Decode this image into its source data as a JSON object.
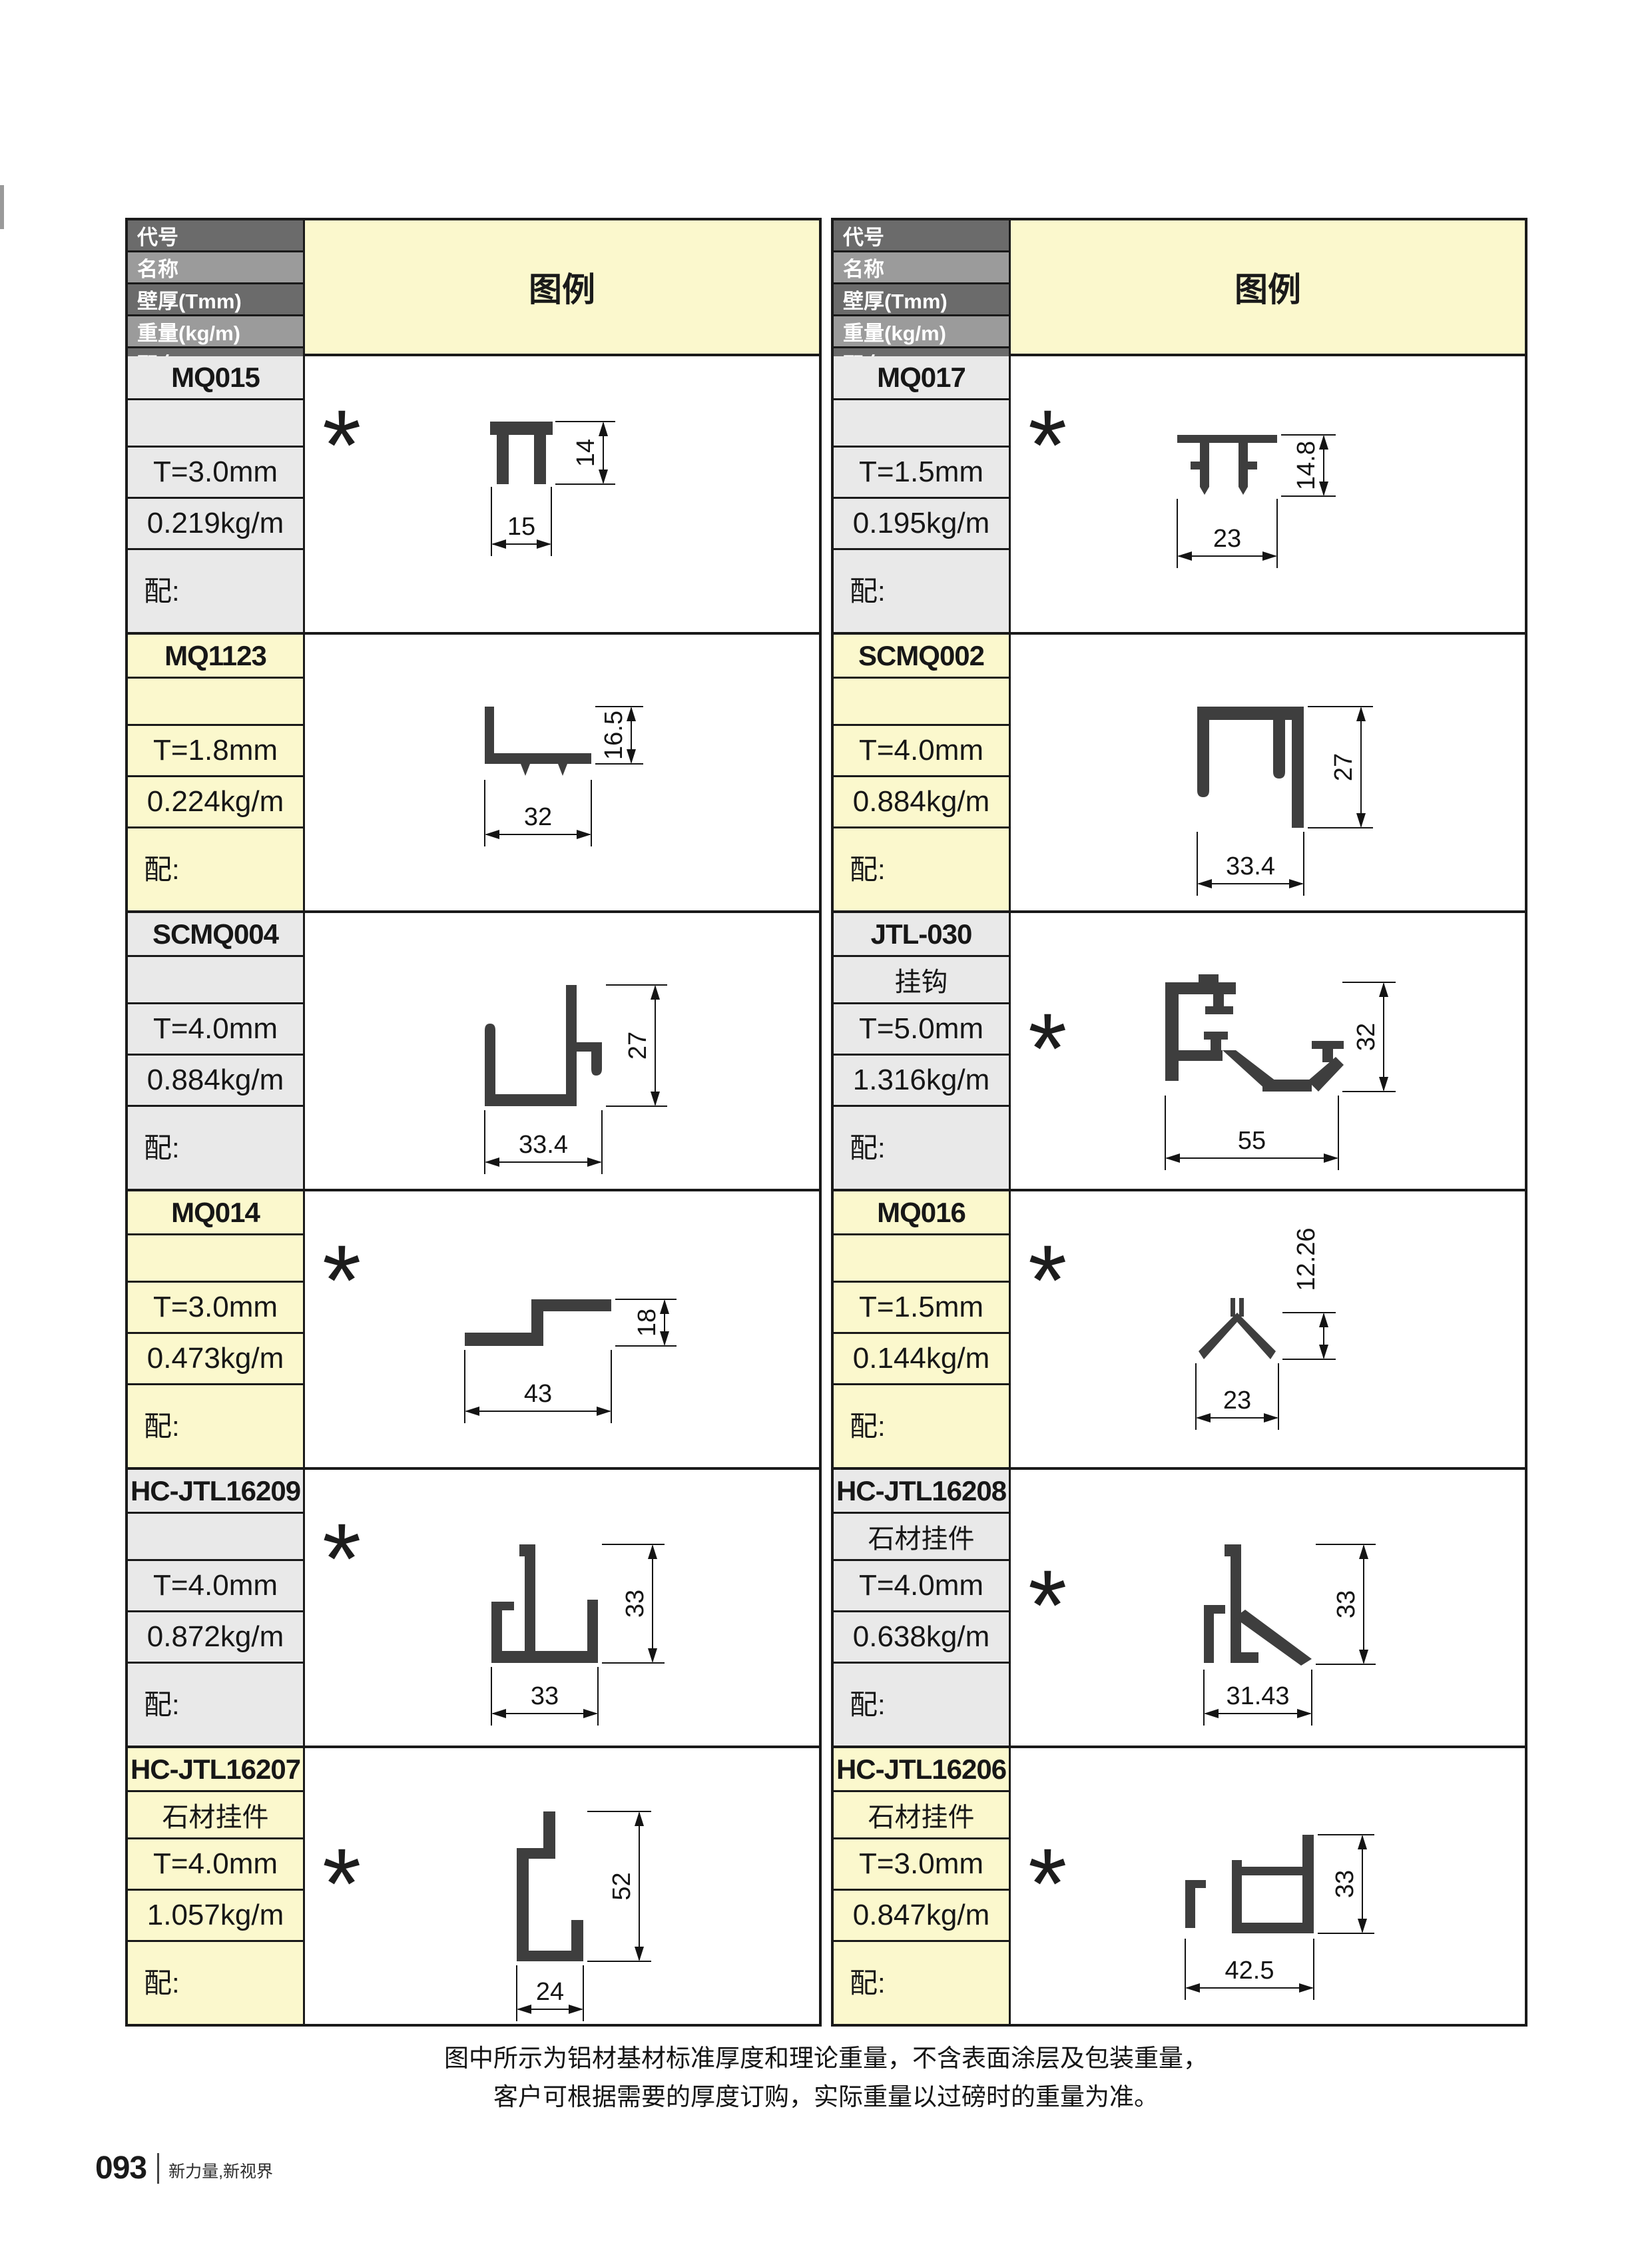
{
  "page": {
    "number": "093",
    "tagline": "新力量,新视界"
  },
  "note": {
    "line1": "图中所示为铝材基材标准厚度和理论重量，不含表面涂层及包装重量，",
    "line2": "客户可根据需要的厚度订购，实际重量以过磅时的重量为准。"
  },
  "table_header": {
    "rows": [
      "代号",
      "名称",
      "壁厚(Tmm)",
      "重量(kg/m)",
      "配套"
    ],
    "legend": "图例"
  },
  "colors": {
    "header_dark": "#6b6b6b",
    "header_light": "#9b9b9b",
    "yellow": "#fbf8cd",
    "gray": "#e9e9e9",
    "profile": "#3e3e3e",
    "dim_line": "#141414"
  },
  "asterisk_symbol": "*",
  "cards": [
    {
      "code": "MQ015",
      "name": "",
      "thickness": "T=3.0mm",
      "weight": "0.219kg/m",
      "fit": "配:",
      "asterisk": true,
      "bg": "gray",
      "dim_w": "15",
      "dim_h": "14"
    },
    {
      "code": "MQ017",
      "name": "",
      "thickness": "T=1.5mm",
      "weight": "0.195kg/m",
      "fit": "配:",
      "asterisk": true,
      "bg": "gray",
      "dim_w": "23",
      "dim_h": "14.8"
    },
    {
      "code": "MQ1123",
      "name": "",
      "thickness": "T=1.8mm",
      "weight": "0.224kg/m",
      "fit": "配:",
      "asterisk": false,
      "bg": "yellow",
      "dim_w": "32",
      "dim_h": "16.5"
    },
    {
      "code": "SCMQ002",
      "name": "",
      "thickness": "T=4.0mm",
      "weight": "0.884kg/m",
      "fit": "配:",
      "asterisk": false,
      "bg": "yellow",
      "dim_w": "33.4",
      "dim_h": "27"
    },
    {
      "code": "SCMQ004",
      "name": "",
      "thickness": "T=4.0mm",
      "weight": "0.884kg/m",
      "fit": "配:",
      "asterisk": false,
      "bg": "gray",
      "dim_w": "33.4",
      "dim_h": "27"
    },
    {
      "code": "JTL-030",
      "name": "挂钩",
      "thickness": "T=5.0mm",
      "weight": "1.316kg/m",
      "fit": "配:",
      "asterisk": true,
      "bg": "gray",
      "dim_w": "55",
      "dim_h": "32"
    },
    {
      "code": "MQ014",
      "name": "",
      "thickness": "T=3.0mm",
      "weight": "0.473kg/m",
      "fit": "配:",
      "asterisk": true,
      "bg": "yellow",
      "dim_w": "43",
      "dim_h": "18"
    },
    {
      "code": "MQ016",
      "name": "",
      "thickness": "T=1.5mm",
      "weight": "0.144kg/m",
      "fit": "配:",
      "asterisk": true,
      "bg": "yellow",
      "dim_w": "23",
      "dim_h": "12.26"
    },
    {
      "code": "HC-JTL16209",
      "name": "",
      "thickness": "T=4.0mm",
      "weight": "0.872kg/m",
      "fit": "配:",
      "asterisk": true,
      "bg": "gray",
      "dim_w": "33",
      "dim_h": "33"
    },
    {
      "code": "HC-JTL16208",
      "name": "石材挂件",
      "thickness": "T=4.0mm",
      "weight": "0.638kg/m",
      "fit": "配:",
      "asterisk": true,
      "bg": "gray",
      "dim_w": "31.43",
      "dim_h": "33"
    },
    {
      "code": "HC-JTL16207",
      "name": "石材挂件",
      "thickness": "T=4.0mm",
      "weight": "1.057kg/m",
      "fit": "配:",
      "asterisk": true,
      "bg": "yellow",
      "dim_w": "24",
      "dim_h": "52"
    },
    {
      "code": "HC-JTL16206",
      "name": "石材挂件",
      "thickness": "T=3.0mm",
      "weight": "0.847kg/m",
      "fit": "配:",
      "asterisk": true,
      "bg": "yellow",
      "dim_w": "42.5",
      "dim_h": "33"
    }
  ]
}
